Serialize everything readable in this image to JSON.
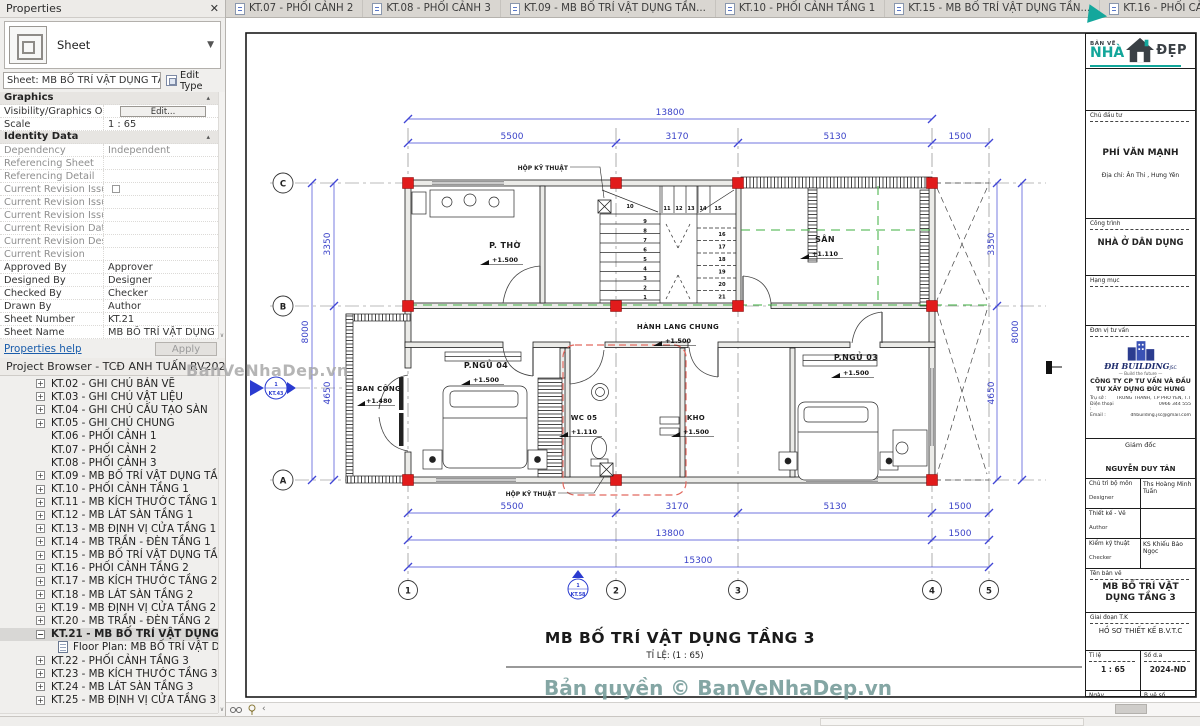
{
  "panel": {
    "title": "Properties",
    "close_icon": "✕",
    "type_selector": "Sheet",
    "instance_selector": "Sheet: MB BỐ TRÍ VẬT DỤNG TẦNG",
    "edit_type": "Edit Type",
    "rows": [
      {
        "k": "section",
        "l": "Graphics"
      },
      {
        "l": "Visibility/Graphics O...",
        "k": "button",
        "v": "Edit..."
      },
      {
        "l": "Scale",
        "v": "1 : 65"
      },
      {
        "k": "section",
        "l": "Identity Data"
      },
      {
        "l": "Dependency",
        "v": "Independent",
        "d": 1
      },
      {
        "l": "Referencing Sheet",
        "d": 1
      },
      {
        "l": "Referencing Detail",
        "d": 1
      },
      {
        "l": "Current Revision Issu...",
        "k": "check",
        "d": 1
      },
      {
        "l": "Current Revision Issu...",
        "d": 1
      },
      {
        "l": "Current Revision Issu...",
        "d": 1
      },
      {
        "l": "Current Revision Date",
        "d": 1
      },
      {
        "l": "Current Revision Des...",
        "d": 1
      },
      {
        "l": "Current Revision",
        "d": 1
      },
      {
        "l": "Approved By",
        "v": "Approver"
      },
      {
        "l": "Designed By",
        "v": "Designer"
      },
      {
        "l": "Checked By",
        "v": "Checker"
      },
      {
        "l": "Drawn By",
        "v": "Author"
      },
      {
        "l": "Sheet Number",
        "v": "KT.21"
      },
      {
        "l": "Sheet Name",
        "v": "MB BỐ TRÍ VẬT DỤNG"
      }
    ],
    "help": "Properties help",
    "apply": "Apply"
  },
  "browser": {
    "title": "Project Browser - TCĐ ANH TUẤN RV2022",
    "items": [
      {
        "label": "KT.02 - GHI CHÚ BẢN VẼ",
        "exp": "plus"
      },
      {
        "label": "KT.03 - GHI CHÚ VẬT LIỆU",
        "exp": "plus"
      },
      {
        "label": "KT.04 - GHI CHÚ CẤU TẠO SÀN",
        "exp": "plus"
      },
      {
        "label": "KT.05 - GHI CHÚ CHUNG",
        "exp": "plus"
      },
      {
        "label": "KT.06 - PHỐI CẢNH 1",
        "exp": "none"
      },
      {
        "label": "KT.07 - PHỐI CẢNH 2",
        "exp": "none"
      },
      {
        "label": "KT.08 - PHỐI CẢNH 3",
        "exp": "none"
      },
      {
        "label": "KT.09 - MB BỐ TRÍ VẬT DỤNG TẦNG 1",
        "exp": "plus"
      },
      {
        "label": "KT.10 - PHỐI CẢNH TẦNG 1",
        "exp": "plus"
      },
      {
        "label": "KT.11 - MB KÍCH THƯỚC TẦNG 1",
        "exp": "plus"
      },
      {
        "label": "KT.12 - MB LÁT SÀN TẦNG 1",
        "exp": "plus"
      },
      {
        "label": "KT.13 - MB ĐỊNH VỊ CỬA TẦNG 1",
        "exp": "plus"
      },
      {
        "label": "KT.14 - MB TRẦN - ĐÈN TẦNG 1",
        "exp": "plus"
      },
      {
        "label": "KT.15 - MB BỐ TRÍ VẬT DỤNG TẦNG 2",
        "exp": "plus"
      },
      {
        "label": "KT.16 - PHỐI CẢNH TẦNG 2",
        "exp": "plus"
      },
      {
        "label": "KT.17 - MB KÍCH THƯỚC TẦNG 2",
        "exp": "plus"
      },
      {
        "label": "KT.18 - MB LÁT SÀN TẦNG 2",
        "exp": "plus"
      },
      {
        "label": "KT.19 - MB ĐỊNH VỊ CỬA TẦNG 2",
        "exp": "plus"
      },
      {
        "label": "KT.20 - MB TRẦN - ĐÈN TẦNG 2",
        "exp": "plus"
      },
      {
        "label": "KT.21 - MB BỐ TRÍ VẬT DỤNG TẦNG",
        "exp": "minus",
        "selected": true
      },
      {
        "label": "Floor Plan: MB BỐ TRÍ VẬT DỤNG",
        "child": true
      },
      {
        "label": "KT.22 - PHỐI CẢNH TẦNG 3",
        "exp": "plus"
      },
      {
        "label": "KT.23 - MB KÍCH THƯỚC TẦNG 3",
        "exp": "plus"
      },
      {
        "label": "KT.24 - MB LÁT SÀN TẦNG 3",
        "exp": "plus"
      },
      {
        "label": "KT.25 - MB ĐỊNH VỊ CỬA TẦNG 3",
        "exp": "plus"
      }
    ]
  },
  "tabs": [
    {
      "label": "KT.07 - PHỐI CẢNH 2"
    },
    {
      "label": "KT.08 - PHỐI CẢNH 3"
    },
    {
      "label": "KT.09 - MB BỐ TRÍ VẬT DỤNG TẦN..."
    },
    {
      "label": "KT.10 - PHỐI CẢNH TẦNG 1"
    },
    {
      "label": "KT.15 - MB BỐ TRÍ VẬT DỤNG TẦN..."
    },
    {
      "label": "KT.16 - PHỐI CẢNH TẦNG 2"
    },
    {
      "label": "KT.21 -",
      "active": true
    }
  ],
  "plan": {
    "grid_cols": [
      "1",
      "2",
      "3",
      "4",
      "5"
    ],
    "grid_rows": [
      "C",
      "B",
      "A"
    ],
    "dims": {
      "col": [
        "5500",
        "3170",
        "5130",
        "1500"
      ],
      "overall": "13800",
      "total": "15300",
      "side": [
        "3350",
        "8000",
        "4650"
      ]
    },
    "rooms": [
      {
        "name": "P. THỜ",
        "level": "+1.500"
      },
      {
        "name": "SÂN",
        "level": "+1.110"
      },
      {
        "name": "HÀNH LANG CHUNG",
        "level": "+1.500"
      },
      {
        "name": "P.NGỦ 04",
        "level": "+1.500"
      },
      {
        "name": "P.NGỦ 03",
        "level": "+1.500"
      },
      {
        "name": "WC 05",
        "level": "+1.110"
      },
      {
        "name": "KHO",
        "level": "+1.500"
      },
      {
        "name": "BAN CÔNG",
        "level": "+1.480"
      }
    ],
    "callout": "HỘP KỸ THUẬT",
    "markers": [
      {
        "num": "1",
        "ref": "KT.43"
      },
      {
        "num": "1",
        "ref": "KT.58"
      }
    ],
    "stair": {
      "left": [
        "1",
        "2",
        "3",
        "4",
        "5",
        "6",
        "7",
        "8",
        "9"
      ],
      "top": [
        "10",
        "11",
        "12",
        "13",
        "14",
        "15"
      ],
      "right": [
        "16",
        "17",
        "18",
        "19",
        "20",
        "21"
      ]
    },
    "title": "MB BỐ TRÍ VẬT DỤNG TẦNG 3",
    "scale_note": "TỈ LỆ: (1 : 65)"
  },
  "titleblock": {
    "logo_line1": "BẢN VẼ",
    "logo_line2": "NHÀ",
    "logo_line3": "ĐẸP",
    "investor_label": "Chủ đầu tư",
    "investor_name": "PHÍ VĂN MẠNH",
    "investor_address": "Địa chỉ: Ân Thi , Hưng Yên",
    "project_label": "Công trình",
    "project_name": "NHÀ Ở DÂN DỤNG",
    "category_label": "Hạng mục",
    "consultant_label": "Đơn vị tư vấn",
    "consultant_logo": "ĐH BUILDING",
    "consultant_logo_suffix": "JSC",
    "consultant_tagline": "— Build the future —",
    "consultant_company": "CÔNG TY CP TƯ VẤN VÀ ĐẦU TƯ XÂY DỰNG ĐỨC HƯNG",
    "office_label": "Trụ sở :",
    "office": "TRUNG THÀNH, T.P PHỔ YÊN, T.THÁI NGUYÊN",
    "phone_label": "Điện thoại :",
    "phone": "0966 344 555",
    "email_label": "Email :",
    "email": "dhbuilding.jsc@gmail.com",
    "director_label": "Giám đốc",
    "director_name": "NGUYỄN DUY TÂN",
    "roles": [
      {
        "label": "Chủ trì bộ môn",
        "sub": "Designer",
        "value": "Ths Hoàng Minh Tuấn"
      },
      {
        "label": "Thiết kế - Vẽ",
        "sub": "Author",
        "value": ""
      },
      {
        "label": "Kiểm kỹ thuật",
        "sub": "Checker",
        "value": "KS Khiếu Bảo Ngọc"
      }
    ],
    "drawing_label": "Tên bản vẽ",
    "drawing_name": "MB BỐ TRÍ VẬT DỤNG TẦNG 3",
    "phase_label": "Giai đoạn T.K",
    "phase": "HỒ SƠ THIẾT KẾ B.V.T.C",
    "scale_label": "Tỉ lệ",
    "scale": "1 : 65",
    "project_no_label": "Số d.a",
    "project_no": "2024-ND",
    "date_label": "Ngày",
    "sheet_no_label": "B.vẽ số"
  },
  "watermarks": {
    "corner": "BanVeNhaDep.vn",
    "bottom": "Bản quyền © BanVeNhaDep.vn"
  }
}
